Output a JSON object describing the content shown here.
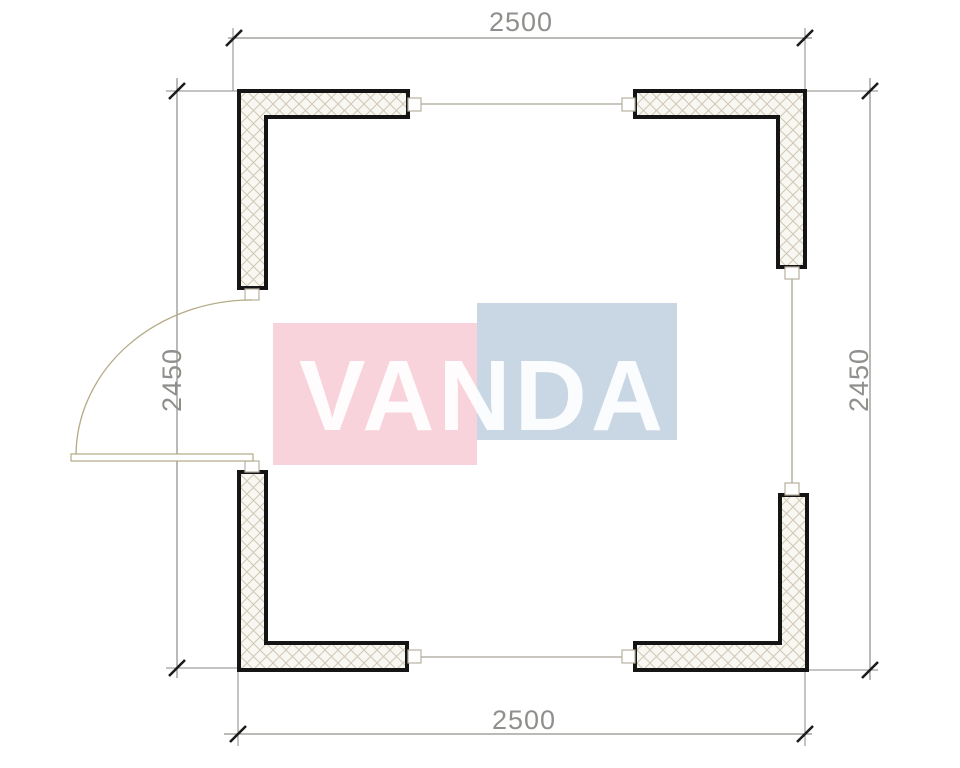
{
  "watermark": {
    "text": "VANDA",
    "colors": {
      "pink": "#f9d3db",
      "blue": "#c9d6e4",
      "text": "#ffffff"
    }
  },
  "dimensions": {
    "top": "2500",
    "bottom": "2500",
    "left": "2450",
    "right": "2450"
  },
  "drawing": {
    "type": "floor-plan",
    "wall_fill": "#f8f7f1",
    "wall_outline": "#151515",
    "hatch_color": "#cfc8b5",
    "dim_line_color": "#75756f",
    "dim_text_color": "#8f8f8c",
    "tick_color": "#1c1c1c",
    "door_color": "#b3ab87",
    "window_color": "#a9a59a"
  }
}
